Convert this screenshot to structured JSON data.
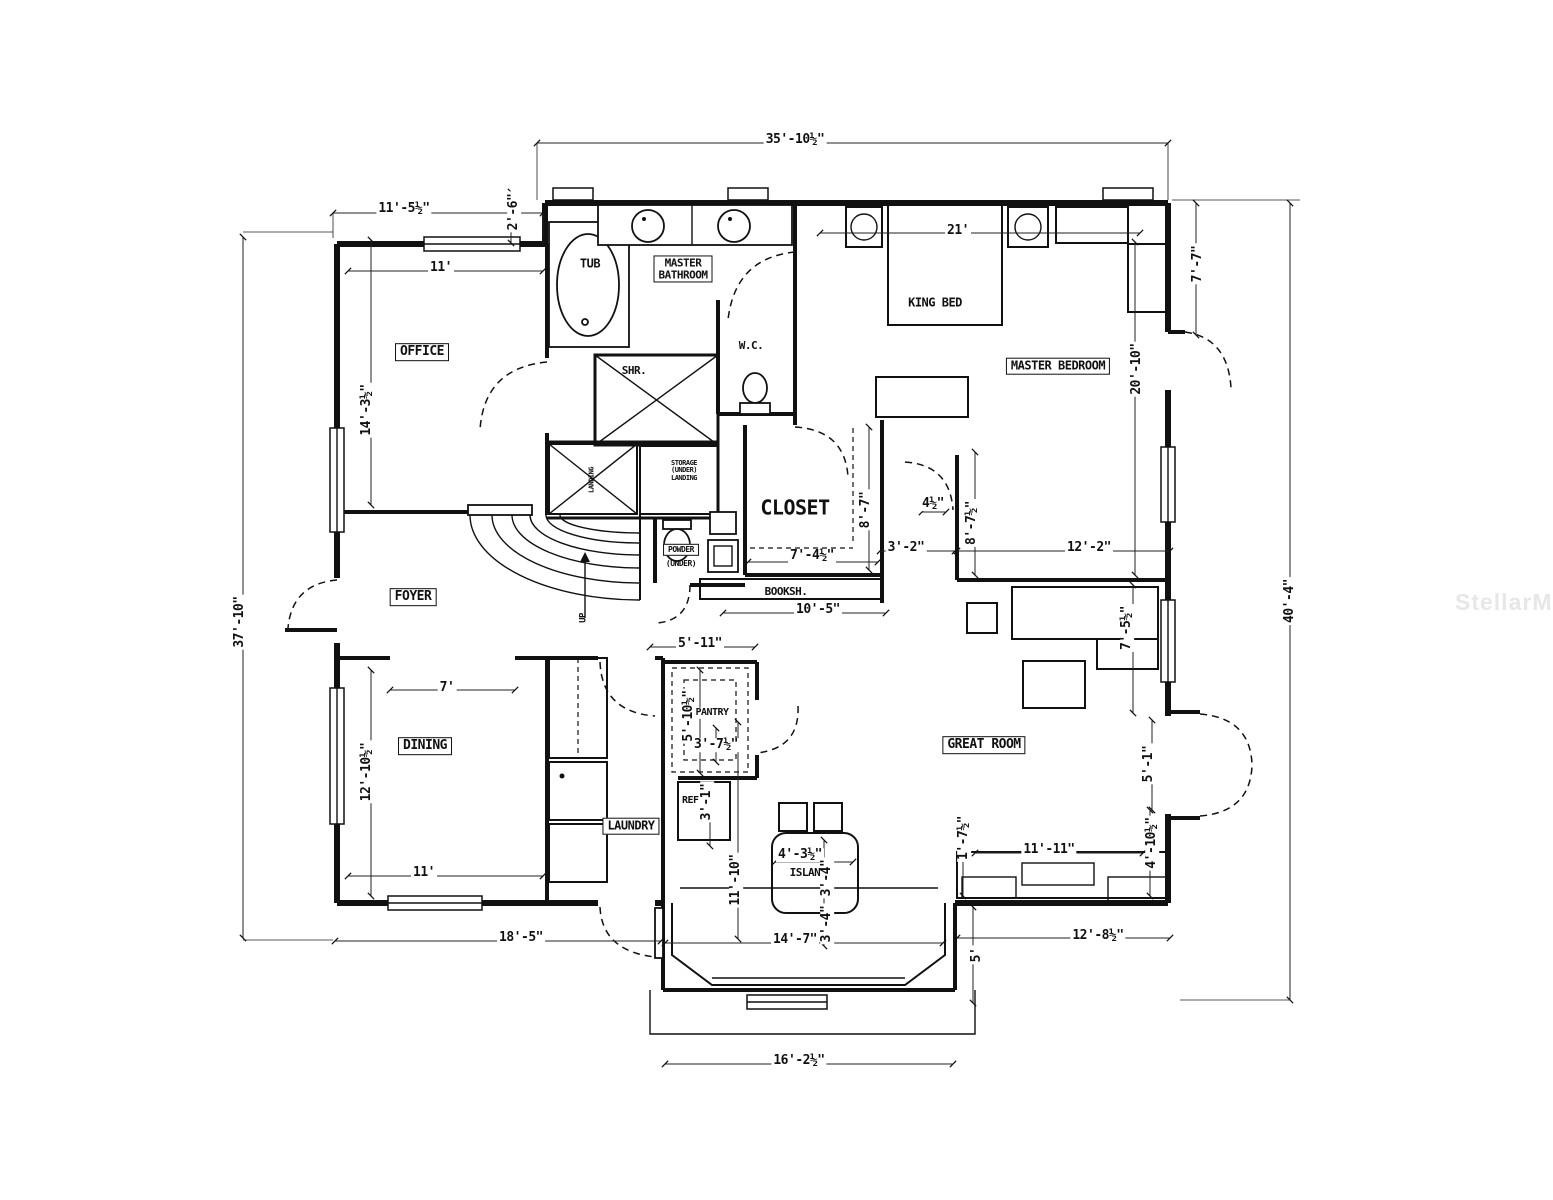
{
  "watermark": {
    "text": "StellarMLS",
    "color": "#e7e7e7"
  },
  "labels": {
    "rooms": [
      {
        "text": "OFFICE",
        "x": 422,
        "y": 352,
        "boxed": true,
        "size": 13
      },
      {
        "text": "MASTER\nBATHROOM",
        "x": 683,
        "y": 269,
        "boxed": true,
        "size": 11
      },
      {
        "text": "FOYER",
        "x": 413,
        "y": 597,
        "boxed": true,
        "size": 13
      },
      {
        "text": "DINING",
        "x": 425,
        "y": 746,
        "boxed": true,
        "size": 13
      },
      {
        "text": "LAUNDRY",
        "x": 631,
        "y": 826,
        "boxed": true,
        "size": 12
      },
      {
        "text": "GREAT ROOM",
        "x": 984,
        "y": 745,
        "boxed": true,
        "size": 13
      },
      {
        "text": "MASTER BEDROOM",
        "x": 1058,
        "y": 366,
        "boxed": true,
        "size": 12
      },
      {
        "text": "CLOSET",
        "x": 795,
        "y": 508,
        "boxed": false,
        "size": 20
      },
      {
        "text": "PANTRY",
        "x": 712,
        "y": 713,
        "boxed": false,
        "size": 10
      }
    ],
    "fixtures": [
      {
        "text": "TUB",
        "x": 590,
        "y": 264,
        "size": 12
      },
      {
        "text": "SHR.",
        "x": 634,
        "y": 371,
        "size": 11
      },
      {
        "text": "W.C.",
        "x": 751,
        "y": 346,
        "size": 11
      },
      {
        "text": "KING BED",
        "x": 935,
        "y": 303,
        "size": 12
      },
      {
        "text": "BOOKSH.",
        "x": 786,
        "y": 592,
        "size": 11
      },
      {
        "text": "REF.",
        "x": 693,
        "y": 801,
        "size": 10
      },
      {
        "text": "ISLAND",
        "x": 808,
        "y": 873,
        "size": 11
      },
      {
        "text": "POWDER",
        "x": 681,
        "y": 550,
        "size": 8,
        "boxed": true
      },
      {
        "text": "(UNDER)",
        "x": 681,
        "y": 564,
        "size": 8
      },
      {
        "text": "STORAGE\n(UNDER)\nLANDING",
        "x": 684,
        "y": 471,
        "size": 7
      },
      {
        "text": "LANDING",
        "x": 592,
        "y": 480,
        "size": 7,
        "rot": -90
      },
      {
        "text": "UP",
        "x": 584,
        "y": 618,
        "size": 9,
        "rot": -90
      }
    ],
    "dimensions": [
      {
        "text": "35'-10½\"",
        "x": 795,
        "y": 140
      },
      {
        "text": "11'-5½\"",
        "x": 404,
        "y": 209
      },
      {
        "text": "2'-6\"",
        "x": 514,
        "y": 212,
        "rot": -90
      },
      {
        "text": "11'",
        "x": 441,
        "y": 268
      },
      {
        "text": "14'-3½\"",
        "x": 367,
        "y": 410,
        "rot": -90
      },
      {
        "text": "37'-10\"",
        "x": 240,
        "y": 622,
        "rot": -90
      },
      {
        "text": "21'",
        "x": 958,
        "y": 231
      },
      {
        "text": "7'-7\"",
        "x": 1198,
        "y": 264,
        "rot": -90
      },
      {
        "text": "40'-4\"",
        "x": 1290,
        "y": 601,
        "rot": -90
      },
      {
        "text": "20'-10\"",
        "x": 1137,
        "y": 369,
        "rot": -90
      },
      {
        "text": "8'-7\"",
        "x": 866,
        "y": 510,
        "rot": -90
      },
      {
        "text": "4½\"",
        "x": 933,
        "y": 504
      },
      {
        "text": "8'-7½\"",
        "x": 972,
        "y": 523,
        "rot": -90
      },
      {
        "text": "3'-2\"",
        "x": 906,
        "y": 548
      },
      {
        "text": "12'-2\"",
        "x": 1089,
        "y": 548
      },
      {
        "text": "7'-4½\"",
        "x": 812,
        "y": 556
      },
      {
        "text": "10'-5\"",
        "x": 818,
        "y": 610
      },
      {
        "text": "7'-5½\"",
        "x": 1127,
        "y": 628,
        "rot": -90
      },
      {
        "text": "5'-1\"",
        "x": 1149,
        "y": 764,
        "rot": -90
      },
      {
        "text": "5'-11\"",
        "x": 700,
        "y": 644
      },
      {
        "text": "5'-10½\"",
        "x": 689,
        "y": 716,
        "rot": -90
      },
      {
        "text": "3'-7½\"",
        "x": 716,
        "y": 745
      },
      {
        "text": "3'-1\"",
        "x": 707,
        "y": 802,
        "rot": -90
      },
      {
        "text": "12'-10½\"",
        "x": 367,
        "y": 772,
        "rot": -90
      },
      {
        "text": "7'",
        "x": 447,
        "y": 688
      },
      {
        "text": "11'",
        "x": 424,
        "y": 873
      },
      {
        "text": "18'-5\"",
        "x": 521,
        "y": 938
      },
      {
        "text": "11'-10\"",
        "x": 736,
        "y": 880,
        "rot": -90
      },
      {
        "text": "4'-3½\"",
        "x": 800,
        "y": 855
      },
      {
        "text": "3'-4\"",
        "x": 827,
        "y": 878,
        "rot": -90
      },
      {
        "text": "3'-4\"",
        "x": 827,
        "y": 924,
        "rot": -90
      },
      {
        "text": "14'-7\"",
        "x": 795,
        "y": 940
      },
      {
        "text": "1'-7½\"",
        "x": 964,
        "y": 838,
        "rot": -90
      },
      {
        "text": "11'-11\"",
        "x": 1049,
        "y": 850
      },
      {
        "text": "4'-10½\"",
        "x": 1152,
        "y": 843,
        "rot": -90
      },
      {
        "text": "12'-8½\"",
        "x": 1098,
        "y": 936
      },
      {
        "text": "5'",
        "x": 977,
        "y": 955,
        "rot": -90
      },
      {
        "text": "16'-2½\"",
        "x": 799,
        "y": 1061
      }
    ]
  }
}
